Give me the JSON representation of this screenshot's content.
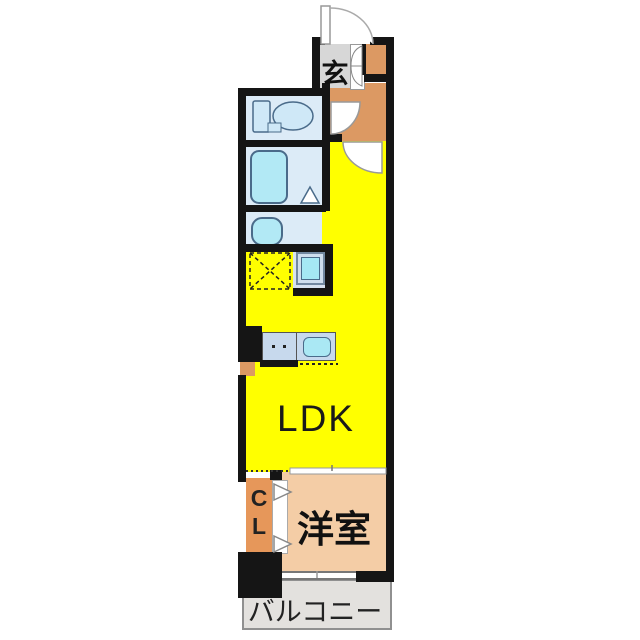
{
  "floorplan": {
    "type": "apartment-floor-plan",
    "labels": {
      "genkan": "玄",
      "ldk": "LDK",
      "closet_line1": "C",
      "closet_line2": "L",
      "western_room": "洋室",
      "balcony": "バルコニー"
    },
    "fixtures": {
      "entrance_door": "entrance-swing-door",
      "shoe_cabinet": "shoe-cabinet-double-door",
      "toilet": "toilet",
      "hall_door": "toilet-room-swing-door",
      "ldk_door": "ldk-entry-swing-door",
      "bathtub": "bathtub",
      "bath_door": "bath-folding-door",
      "washbasin": "washbasin",
      "washing_machine": "washing-machine-pan",
      "refrigerator_space": "refrigerator-space-dashed-box",
      "kitchen_counter": "kitchen-counter-with-sink-and-burners",
      "closet_doors": "closet-folding-doors",
      "sliding_door": "ldk-bedroom-sliding-door",
      "window": "bedroom-balcony-window"
    },
    "colors": {
      "wall_black": "#151515",
      "ldk_yellow": "#ffff00",
      "hall_orange": "#dc9963",
      "closet_orange": "#e6975a",
      "room_peach": "#f4cda6",
      "balcony_gray": "#e3e1de",
      "genkan_gray": "#d7d7d7",
      "wet_area_blue": "#dcebf7",
      "fixture_cyan": "#aee8f4",
      "counter_blue": "#c7d9ed"
    }
  }
}
